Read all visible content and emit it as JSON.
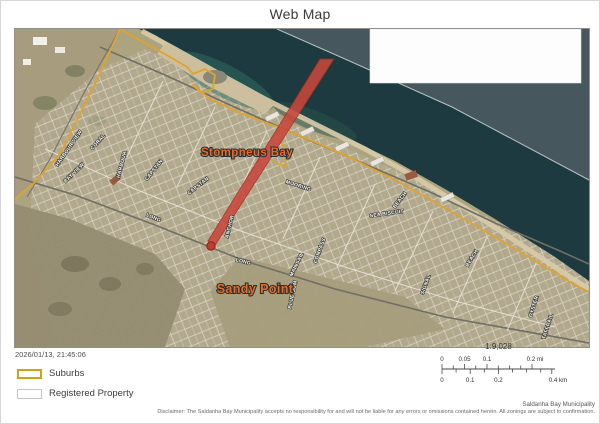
{
  "page": {
    "title": "Web Map"
  },
  "map": {
    "place_labels": [
      {
        "t": "Stompneus Bay",
        "x": 232,
        "y": 127,
        "size": 11.5
      },
      {
        "t": "Sandy Point",
        "x": 240,
        "y": 264,
        "size": 12.5
      }
    ],
    "street_labels": [
      {
        "t": "HARBOUR VIEW",
        "x": 55,
        "y": 120,
        "r": -55
      },
      {
        "t": "CORAL",
        "x": 84,
        "y": 114,
        "r": -48
      },
      {
        "t": "BAY VIEW",
        "x": 60,
        "y": 145,
        "r": -44
      },
      {
        "t": "HARBOUR",
        "x": 108,
        "y": 136,
        "r": -75
      },
      {
        "t": "CAPSTAN",
        "x": 140,
        "y": 142,
        "r": -52
      },
      {
        "t": "CAPSTAN",
        "x": 184,
        "y": 158,
        "r": -38
      },
      {
        "t": "LONG",
        "x": 138,
        "y": 190,
        "r": 22
      },
      {
        "t": "LONG",
        "x": 228,
        "y": 234,
        "r": 14
      },
      {
        "t": "ANCHOR",
        "x": 216,
        "y": 198,
        "r": -76
      },
      {
        "t": "MOORING",
        "x": 283,
        "y": 158,
        "r": 18
      },
      {
        "t": "COMPASS",
        "x": 306,
        "y": 222,
        "r": -70
      },
      {
        "t": "MAINSAIL",
        "x": 283,
        "y": 236,
        "r": -64
      },
      {
        "t": "SEA BISCUIT",
        "x": 372,
        "y": 186,
        "r": -8
      },
      {
        "t": "BEACH",
        "x": 386,
        "y": 172,
        "r": -52
      },
      {
        "t": "BEACH",
        "x": 458,
        "y": 230,
        "r": -58
      },
      {
        "t": "SIGNAL",
        "x": 412,
        "y": 256,
        "r": -70
      },
      {
        "t": "OYSTER",
        "x": 520,
        "y": 278,
        "r": -72
      },
      {
        "t": "TAFFRAIL",
        "x": 534,
        "y": 298,
        "r": -72
      },
      {
        "t": "BLUE GUM",
        "x": 279,
        "y": 266,
        "r": -78
      }
    ],
    "layers": {
      "suburb_boundary_color": "#dfa32e",
      "selection_color": "#c8473b"
    }
  },
  "footer": {
    "timestamp": "2026/01/13, 21:45:06",
    "legend": [
      {
        "label": "Suburbs"
      },
      {
        "label": "Registered Property"
      }
    ],
    "scale": {
      "ratio": "1:9,028",
      "mi_ticks": [
        "0",
        "0.05",
        "0.1",
        "0.2 mi"
      ],
      "km_ticks": [
        "0",
        "0.1",
        "0.2",
        "0.4 km"
      ]
    },
    "credit": "Saldanha Bay Municipality",
    "disclaimer": "Disclaimer: The Saldanha Bay Municipality accepts no responsibility for and will not be liable for any errors or omissions contained herein.  All zonings are subject to confirmation."
  }
}
